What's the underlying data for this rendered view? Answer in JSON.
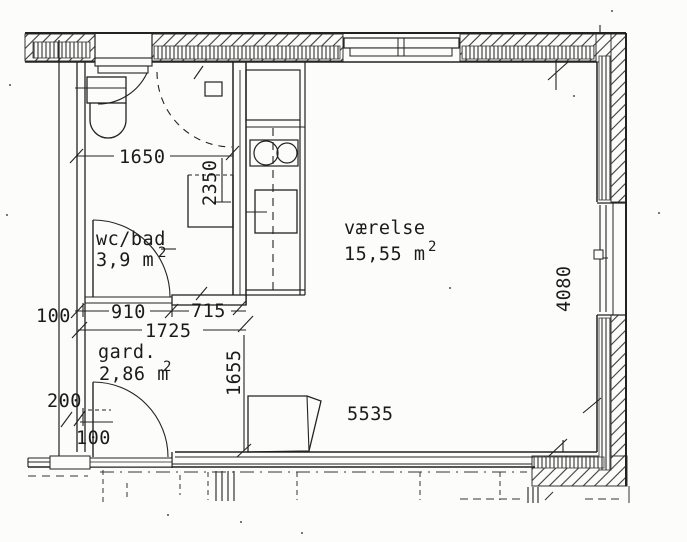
{
  "plan": {
    "rooms": {
      "bath": {
        "name": "wc/bad",
        "area": "3,9 m",
        "sup": "2"
      },
      "main": {
        "name": "værelse",
        "area": "15,55 m",
        "sup": "2"
      },
      "wardrobe": {
        "name": "gard.",
        "area": "2,86 m",
        "sup": "2"
      }
    },
    "dims": {
      "bath_width": "1650",
      "bath_depth": "2350",
      "bath_door_width": "910",
      "bath_wall": "715",
      "entry_width": "1725",
      "wall_left": "100",
      "entry_depth": "1655",
      "door_offset": "200",
      "door_jamb": "100",
      "total_width": "5535",
      "total_depth": "4080"
    }
  }
}
